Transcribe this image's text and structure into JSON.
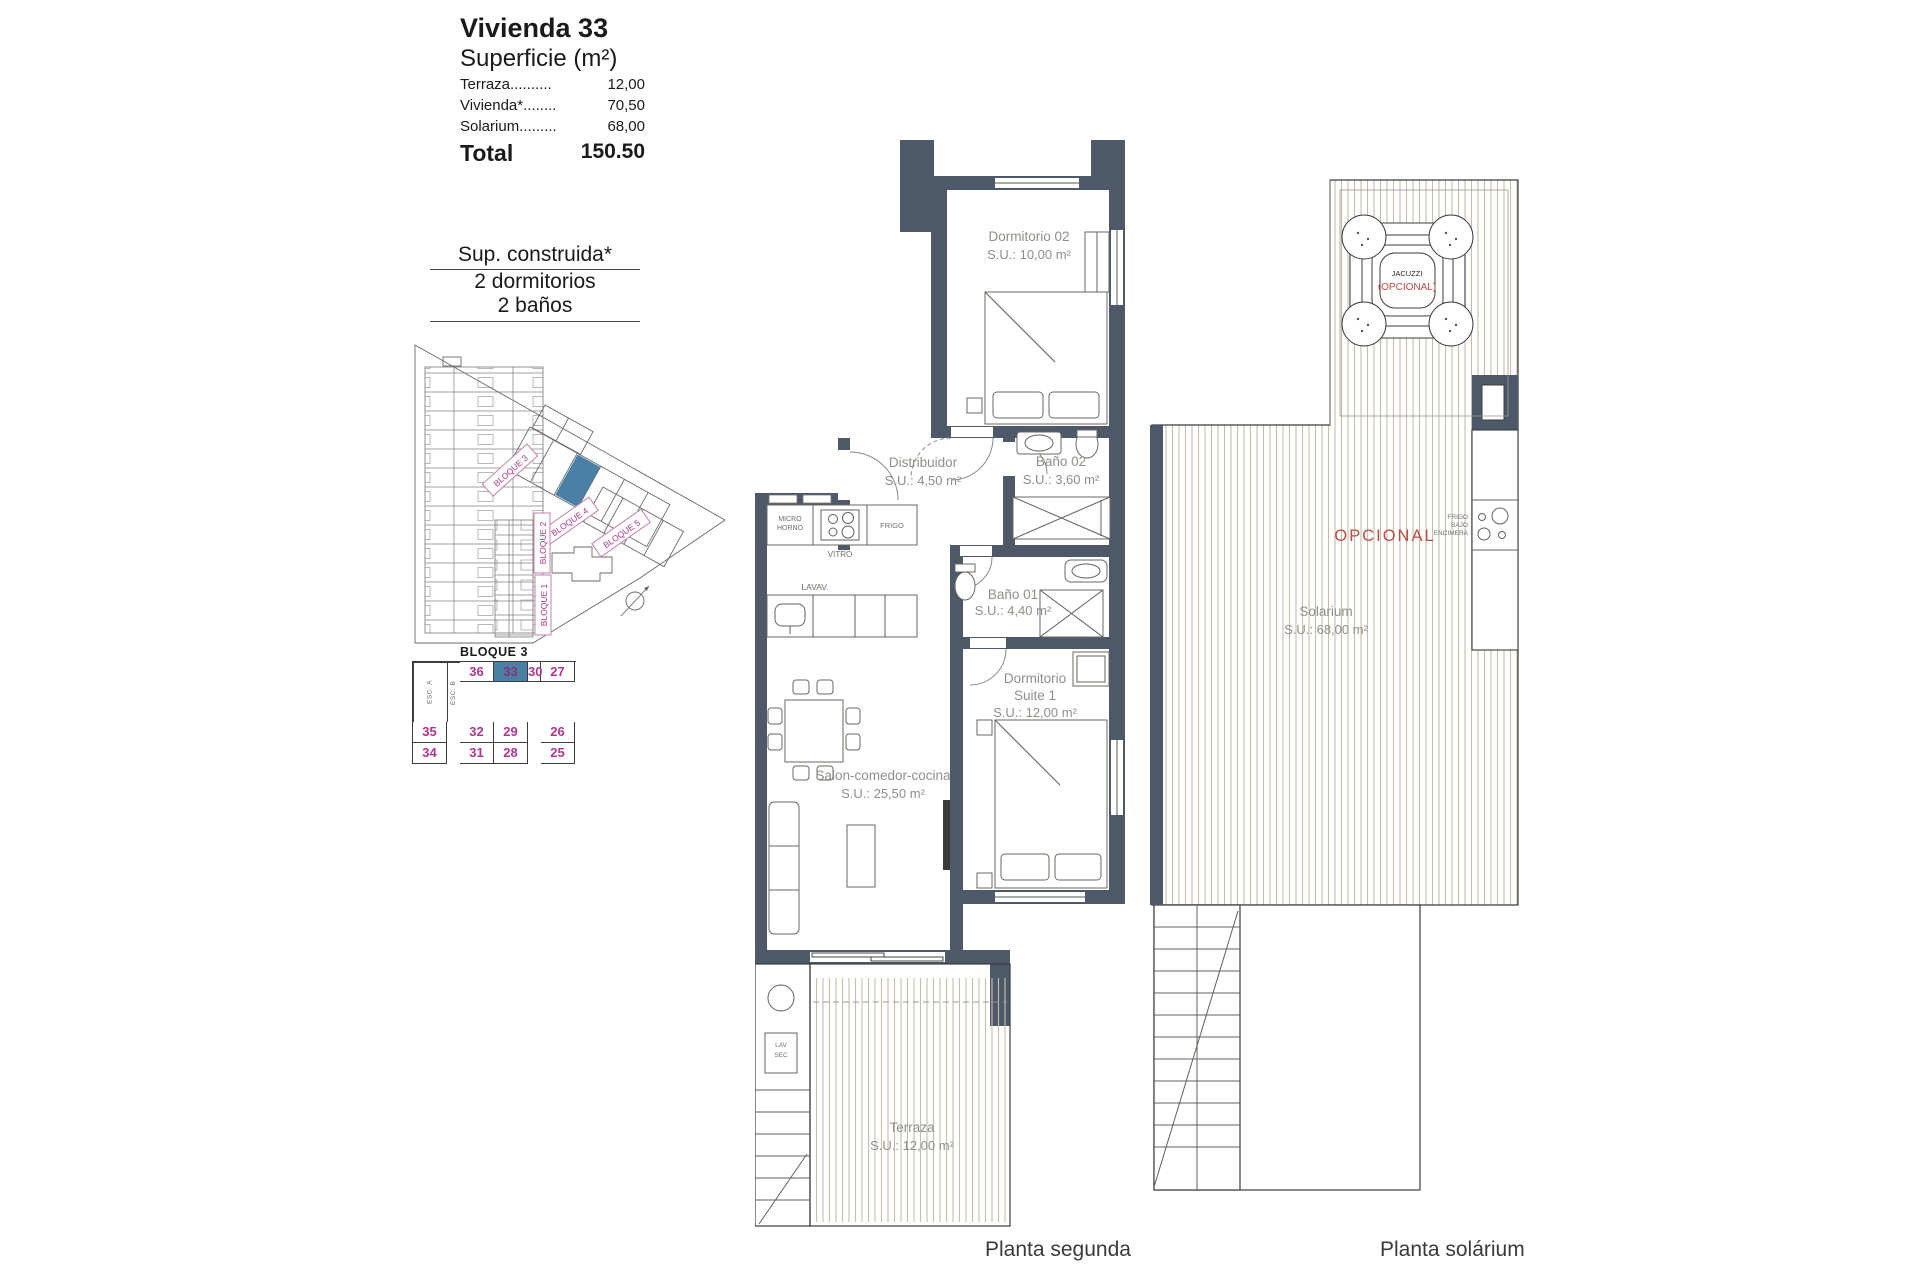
{
  "info": {
    "title": "Vivienda 33",
    "subtitle": "Superficie (m²)",
    "rows": [
      {
        "label": "Terraza..........",
        "value": "12,00"
      },
      {
        "label": "Vivienda*........",
        "value": "70,50"
      },
      {
        "label": "Solarium.........",
        "value": "68,00"
      }
    ],
    "total_label": "Total",
    "total_value": "150.50"
  },
  "spec": {
    "line1": "Sup. construida*",
    "line2": "2 dormitorios",
    "line3": "2 baños"
  },
  "site": {
    "bloque1": "BLOQUE 1",
    "bloque2": "BLOQUE 2",
    "bloque3": "BLOQUE 3",
    "bloque4": "BLOQUE 4",
    "bloque5": "BLOQUE 5"
  },
  "block_table": {
    "title": "BLOQUE 3",
    "esc_a": "ESC. A",
    "esc_b": "ESC. B",
    "rows": [
      [
        "36",
        "33",
        "30",
        "27"
      ],
      [
        "35",
        "32",
        "29",
        "26"
      ],
      [
        "34",
        "31",
        "28",
        "25"
      ]
    ],
    "highlighted": "33"
  },
  "plan2": {
    "caption": "Planta segunda",
    "dorm02_name": "Dormitorio 02",
    "dorm02_area": "S.U.: 10,00 m²",
    "distribuidor_name": "Distribuidor",
    "distribuidor_area": "S.U.: 4,50 m²",
    "bano02_name": "Baño 02",
    "bano02_area": "S.U.: 3,60 m²",
    "bano01_name": "Baño 01",
    "bano01_area": "S.U.: 4,40 m²",
    "suite_name1": "Dormitorio",
    "suite_name2": "Suite 1",
    "suite_area": "S.U.: 12,00 m²",
    "salon_name": "Salon-comedor-cocina",
    "salon_area": "S.U.: 25,50 m²",
    "terraza_name": "Terraza",
    "terraza_area": "S.U.: 12,00 m²",
    "micro1": "MICRO",
    "micro2": "HORNO",
    "vitro": "VITRO",
    "frigo": "FRIGO",
    "lavav": "LAVAV.",
    "lav": "LAV",
    "sec": "SEC"
  },
  "solarium": {
    "caption": "Planta solárium",
    "name": "Solarium",
    "area": "S.U.: 68,00 m²",
    "opcional": "OPCIONAL",
    "jacuzzi": "JACUZZI",
    "jacuzzi_opcional": "(OPCIONAL)",
    "frigo1": "FRIGO",
    "frigo2": "BAJO",
    "frigo3": "ENCIMERA"
  },
  "colors": {
    "wall": "#4d5969",
    "hatch": "#c6bda9",
    "magenta": "#b0368d",
    "highlight_blue": "#4a80a6",
    "optional_red": "#bf4a44",
    "room_label": "#8f8f88"
  }
}
